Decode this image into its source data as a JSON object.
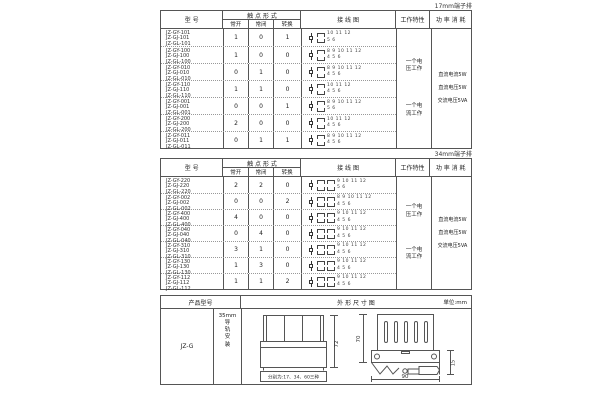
{
  "table1": {
    "corner_label": "17mm端子排",
    "headers": {
      "model": "型 号",
      "contact_form": "触 点 形 式",
      "no": "常开",
      "nc": "常闭",
      "co": "转换",
      "wiring": "接 线 图",
      "characteristic": "工作特性",
      "power": "功 率 消 耗"
    },
    "rows": [
      {
        "models": "JZ-GY-101\nJZ-GJ-101\nJZ-GL-101",
        "no": "1",
        "nc": "0",
        "co": "1",
        "top_terminals": "10 11 12",
        "bottom_terminals": "5 6"
      },
      {
        "models": "JZ-GY-100\nJZ-GJ-100\nJZ-GL-100",
        "no": "1",
        "nc": "0",
        "co": "0",
        "top_terminals": "8 9 10 11 12",
        "bottom_terminals": "4 5 6"
      },
      {
        "models": "JZ-GY-010\nJZ-GJ-010\nJZ-GL-010",
        "no": "0",
        "nc": "1",
        "co": "0",
        "top_terminals": "8 9 10 11 12",
        "bottom_terminals": "4 5 6"
      },
      {
        "models": "JZ-GY-110\nJZ-GJ-110\nJZ-GL-110",
        "no": "1",
        "nc": "1",
        "co": "0",
        "top_terminals": "10 11 12",
        "bottom_terminals": "4 5 6"
      },
      {
        "models": "JZ-GY-001\nJZ-GJ-001\nJZ-GL-001",
        "no": "0",
        "nc": "0",
        "co": "1",
        "top_terminals": "8 9 10 11 12",
        "bottom_terminals": "5 6"
      },
      {
        "models": "JZ-GY-200\nJZ-GJ-200\nJZ-GL-200",
        "no": "2",
        "nc": "0",
        "co": "0",
        "top_terminals": "10 11 12",
        "bottom_terminals": "4 5 6"
      },
      {
        "models": "JZ-GY-011\nJZ-GJ-011\nJZ-GL-011",
        "no": "0",
        "nc": "1",
        "co": "1",
        "top_terminals": "8 9 10 11 12",
        "bottom_terminals": "4 5 6"
      }
    ],
    "characteristics": [
      "一个电\n压工作",
      "一个电\n流工作"
    ],
    "power_lines": [
      "直流电流5W",
      "直流电压5W",
      "交流电压5VA"
    ]
  },
  "table2": {
    "corner_label": "34mm端子排",
    "headers": {
      "model": "型 号",
      "contact_form": "触 点 形 式",
      "no": "常开",
      "nc": "常闭",
      "co": "转换",
      "wiring": "接 线 图",
      "characteristic": "工作特性",
      "power": "功 率 消 耗"
    },
    "rows": [
      {
        "models": "JZ-GY-220\nJZ-GJ-220\nJZ-GL-220",
        "no": "2",
        "nc": "2",
        "co": "0",
        "top_terminals": "9 10 11 12",
        "bottom_terminals": "5 6"
      },
      {
        "models": "JZ-GY-002\nJZ-GJ-002\nJZ-GL-002",
        "no": "0",
        "nc": "0",
        "co": "2",
        "top_terminals": "8 9 10 11 12",
        "bottom_terminals": "4 5 6"
      },
      {
        "models": "JZ-GY-400\nJZ-GJ-400\nJZ-GL-400",
        "no": "4",
        "nc": "0",
        "co": "0",
        "top_terminals": "9 10 11 12",
        "bottom_terminals": "4 5 6"
      },
      {
        "models": "JZ-GY-040\nJZ-GJ-040\nJZ-GL-040",
        "no": "0",
        "nc": "4",
        "co": "0",
        "top_terminals": "9 10 11 12",
        "bottom_terminals": "4 5 6"
      },
      {
        "models": "JZ-GY-310\nJZ-GJ-310\nJZ-GL-310",
        "no": "3",
        "nc": "1",
        "co": "0",
        "top_terminals": "9 10 11 12",
        "bottom_terminals": "4 5 6"
      },
      {
        "models": "JZ-GY-130\nJZ-GJ-130\nJZ-GL-130",
        "no": "1",
        "nc": "3",
        "co": "0",
        "top_terminals": "9 10 11 12",
        "bottom_terminals": "4 5 6"
      },
      {
        "models": "JZ-GY-112\nJZ-GJ-112\nJZ-GL-112",
        "no": "1",
        "nc": "1",
        "co": "2",
        "top_terminals": "9 10 11 12",
        "bottom_terminals": "4 5 6"
      }
    ],
    "characteristics": [
      "一个电\n压工作",
      "一个电\n流工作"
    ],
    "power_lines": [
      "直流电流5W",
      "直流电压5W",
      "交流电压5VA"
    ]
  },
  "table3": {
    "headers": {
      "product_model": "产品型号",
      "outline": "外 形 尺 寸 图",
      "unit": "单位:mm"
    },
    "model": "JZ-G",
    "mounting": "35mm\n导\n轨\n安\n装",
    "front_view": {
      "height_dim": "72",
      "width_note": "分别为:17、34、60三种"
    },
    "side_view": {
      "height_dim": "70",
      "clip_dim": "15",
      "width_dim": "90"
    }
  }
}
